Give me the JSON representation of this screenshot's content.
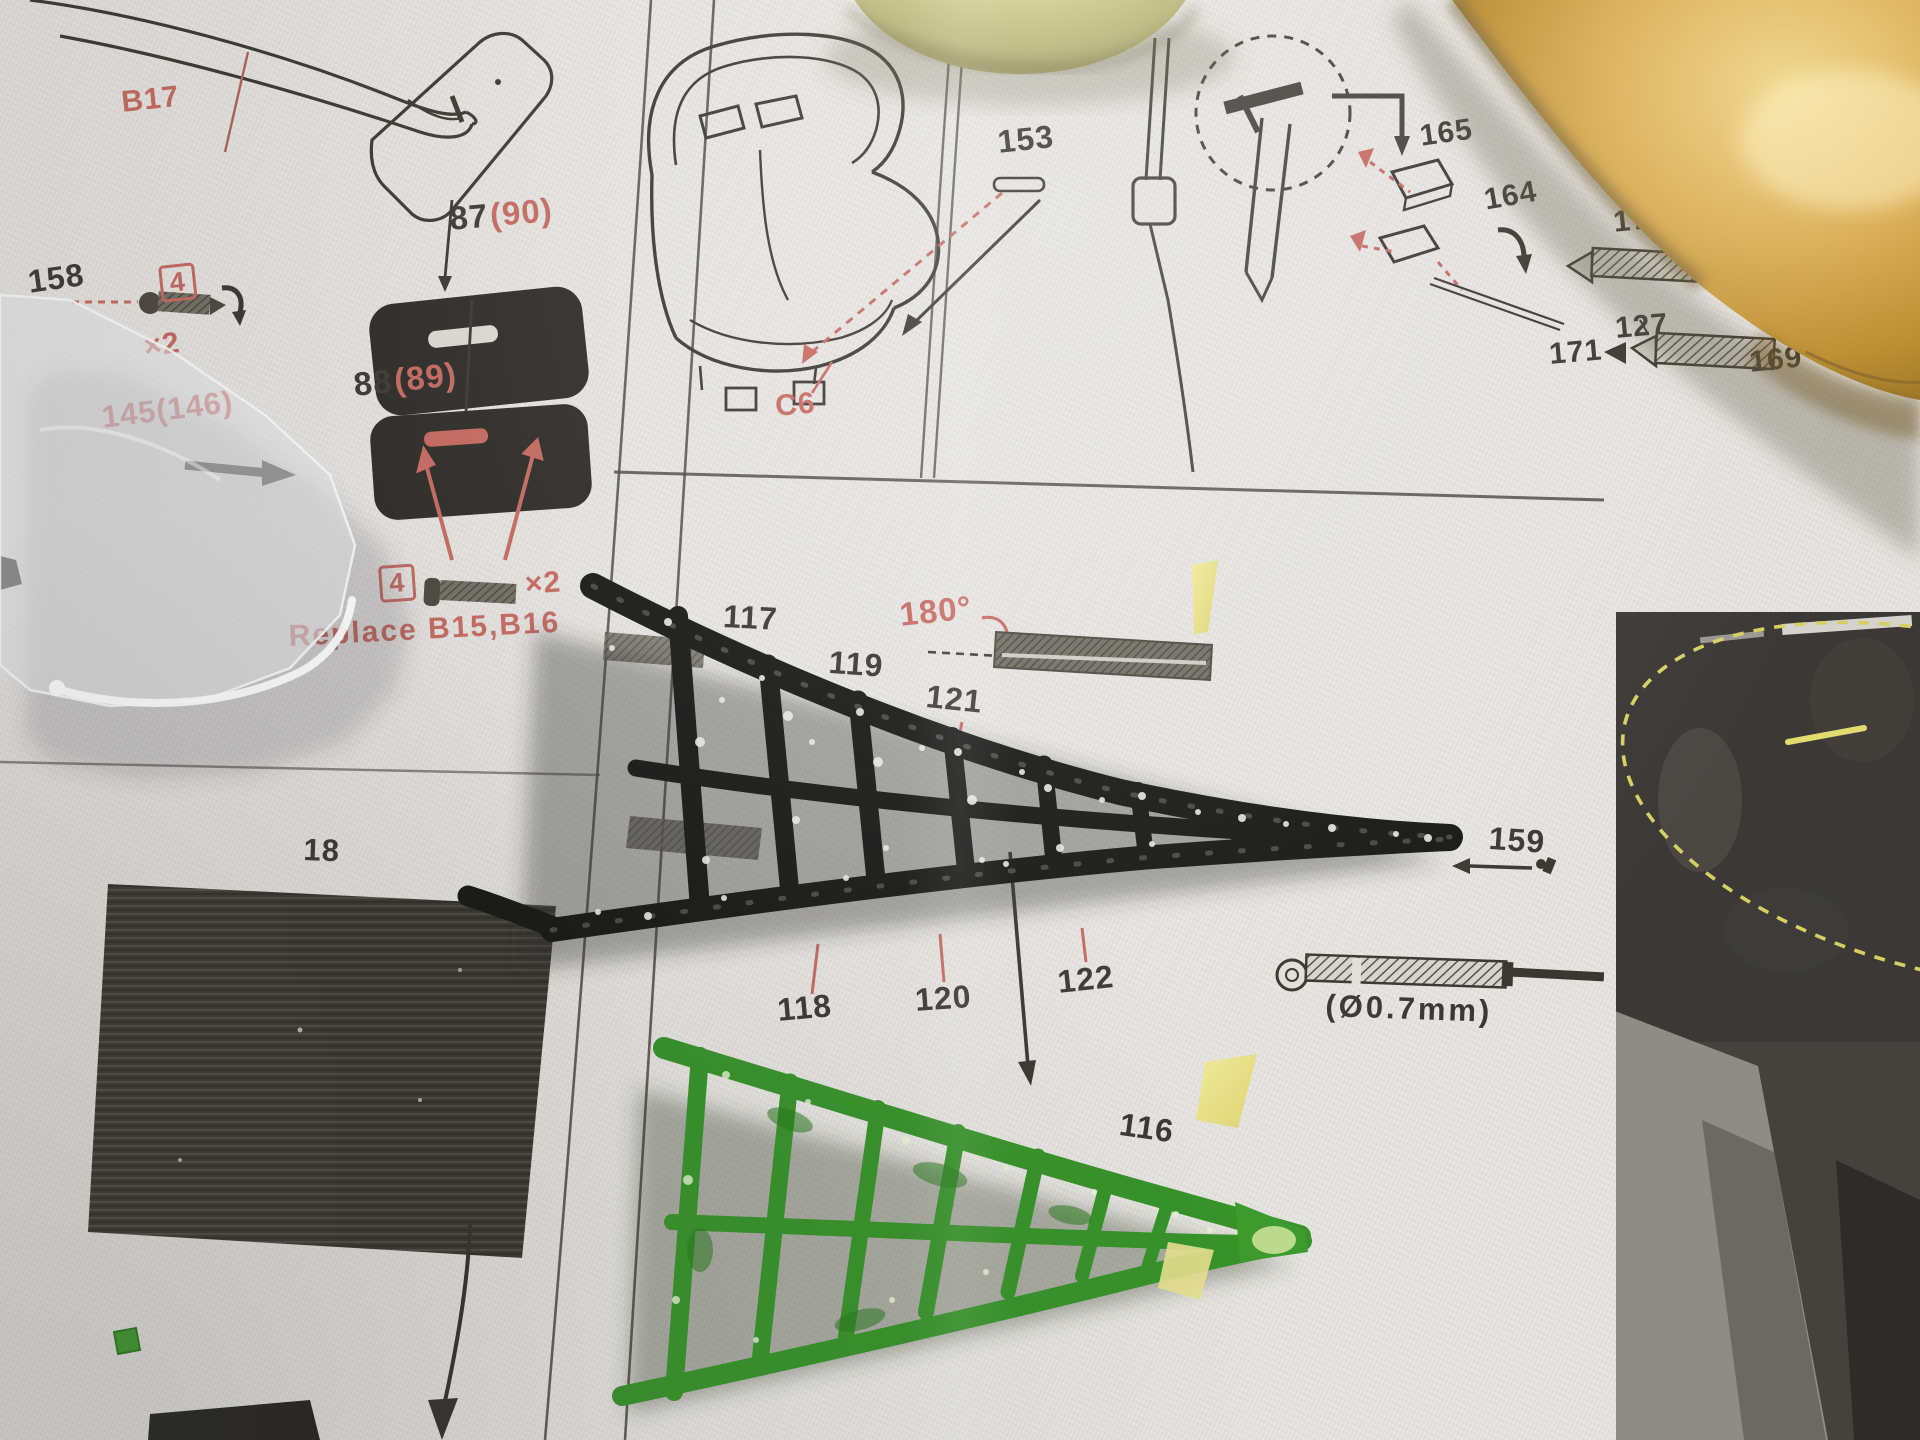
{
  "labels": {
    "b17": "B17",
    "n158": "158",
    "qty4_top": "4",
    "x2_top": "×2",
    "n87": "87",
    "n90": "(90)",
    "n88": "88",
    "n89": "(89)",
    "n145": "145(146)",
    "qty4_bottom": "4",
    "x2_bottom": "×2",
    "replace_note": "Replace B15,B16",
    "n153": "153",
    "c6": "C6",
    "n165": "165",
    "n164": "164",
    "n171_top": "171",
    "n127_top": "127",
    "n127_bottom": "127",
    "n171_bottom": "171",
    "n169": "169",
    "deg180": "180°",
    "n117": "117",
    "n119": "119",
    "n121": "121",
    "n159": "159",
    "n118": "118",
    "n120": "120",
    "n122": "122",
    "n116": "116",
    "n18": "18",
    "diameter_note": "(Ø0.7mm)"
  },
  "colors": {
    "accent_red": "#c4685f",
    "ink": "#3b3733",
    "paper": "#e7e5e1",
    "tape_yellow": "#eae387",
    "part_green": "#3f9d2b",
    "photo_dash_yellow": "#d6d063"
  }
}
